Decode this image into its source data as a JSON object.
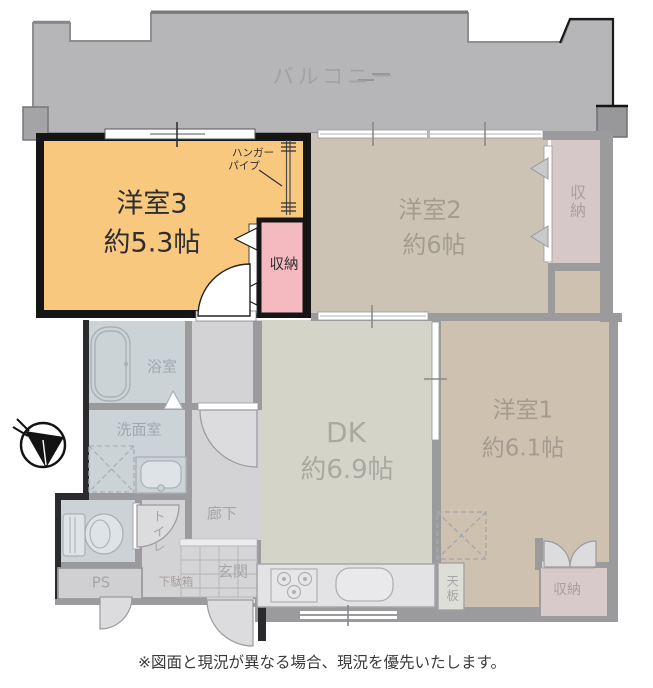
{
  "balcony": {
    "label": "バルコニー"
  },
  "highlight": {
    "room3": {
      "name": "洋室3",
      "size": "約5.3帖"
    },
    "closet": {
      "label": "収納"
    },
    "hanger_pipe": {
      "line1": "ハンガー",
      "line2": "パイプ"
    }
  },
  "rooms": {
    "room2": {
      "name": "洋室2",
      "size": "約6帖"
    },
    "room2_closet": {
      "label": "収納"
    },
    "room1": {
      "name": "洋室1",
      "size": "約6.1帖"
    },
    "room1_closet": {
      "label": "収納"
    },
    "dk": {
      "name": "DK",
      "size": "約6.9帖"
    },
    "bathroom": {
      "label": "浴室"
    },
    "washroom": {
      "label": "洗面室"
    },
    "toilet": {
      "label": "トイレ"
    },
    "hallway": {
      "label": "廊下"
    },
    "entrance": {
      "label": "玄関"
    },
    "pipe_space": {
      "label": "PS"
    },
    "shoe_cabinet": {
      "label": "下駄箱"
    },
    "counter_top": {
      "label": "天板"
    }
  },
  "caption": "※図面と現況が異なる場合、現況を優先いたします。",
  "colors": {
    "highlight_room_fill": "#f9c87f",
    "highlight_closet_fill": "#f5b9c0",
    "highlight_wall": "#151515",
    "balcony_fill": "#b6b6b8",
    "room2_fill": "#cdc3b5",
    "room2_closet_fill": "#d6c8c8",
    "room1_fill": "#cfc1af",
    "room1_closet_fill": "#d8caca",
    "dk_fill": "#d4d4c9",
    "bath_fill": "#ccd3d7",
    "hall_fill": "#d3d3d5",
    "shoe_fill": "#e8d2d2"
  }
}
